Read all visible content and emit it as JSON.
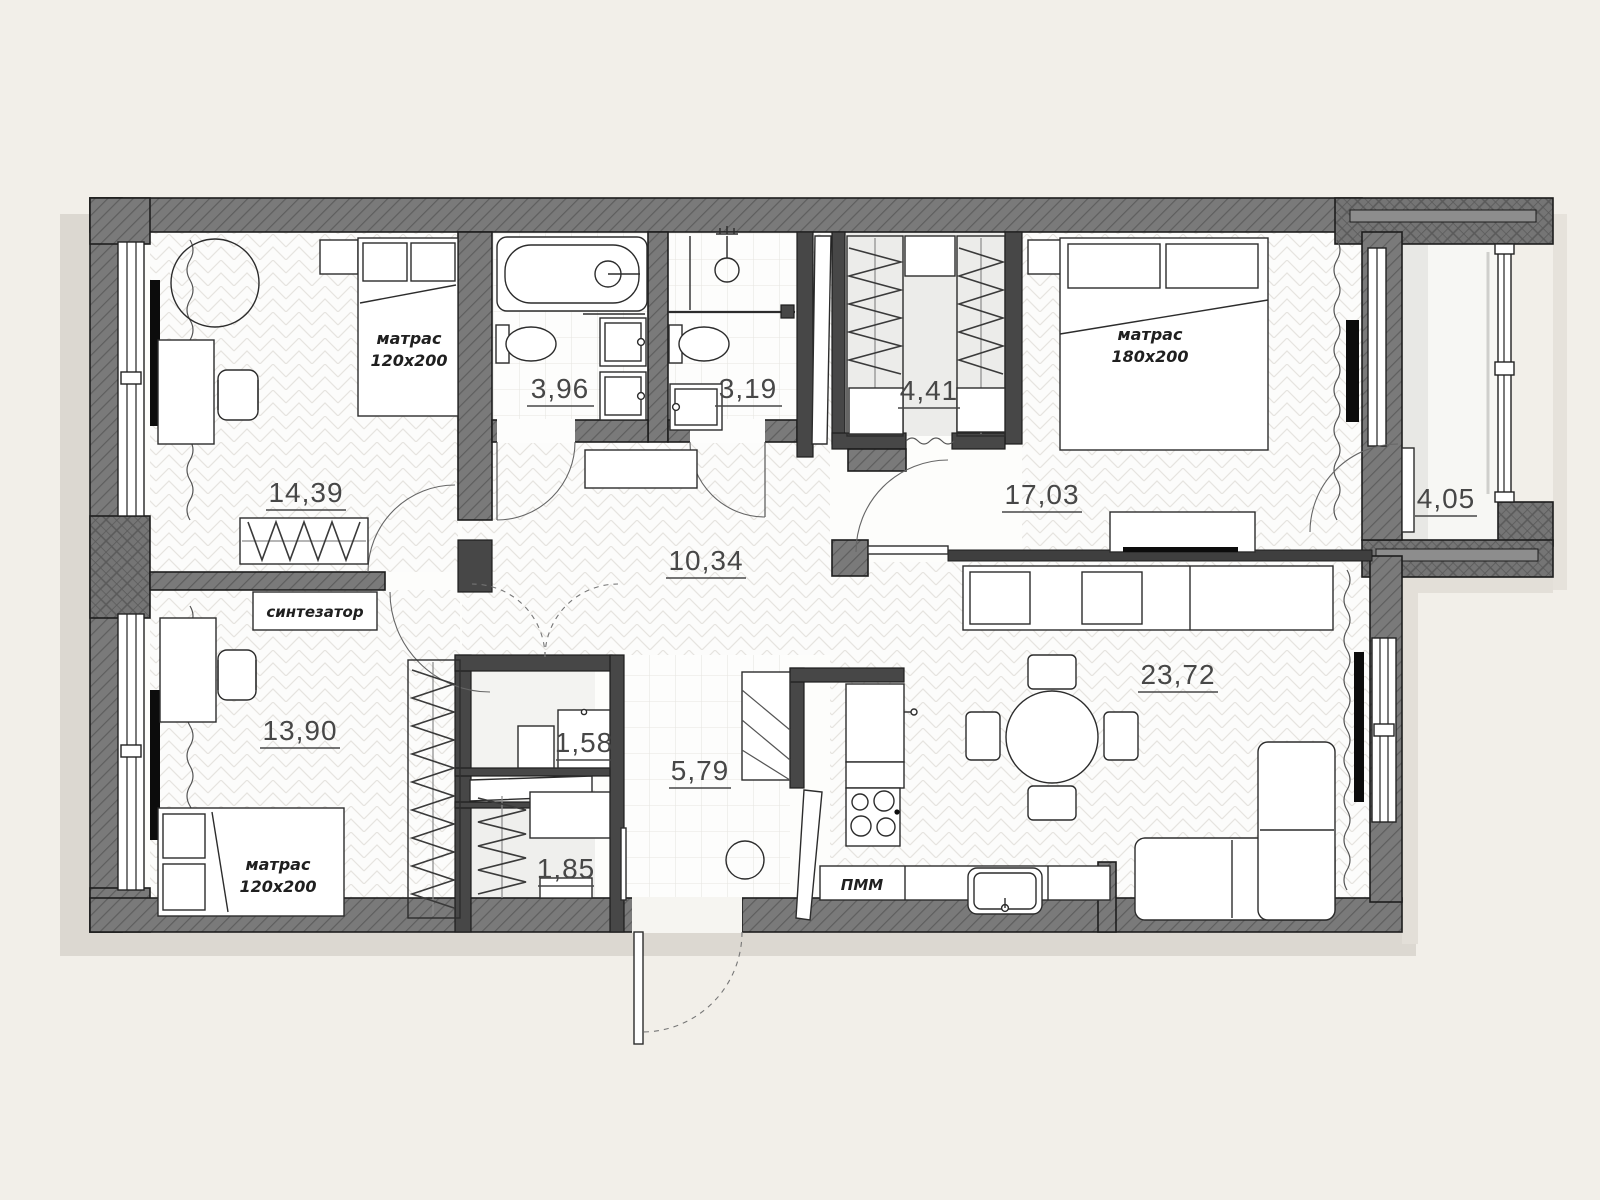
{
  "plan": {
    "background_color": "#f2efe9",
    "wall_color": "#767676",
    "partition_color": "#474747",
    "line_color": "#2c2c2c",
    "label_color": "#474747",
    "rooms": [
      {
        "id": "bedroom-top-left",
        "area": "14,39"
      },
      {
        "id": "bathroom",
        "area": "3,96"
      },
      {
        "id": "shower-room",
        "area": "3,19"
      },
      {
        "id": "wardrobe",
        "area": "4,41"
      },
      {
        "id": "master-bedroom",
        "area": "17,03"
      },
      {
        "id": "balcony",
        "area": "4,05"
      },
      {
        "id": "hallway",
        "area": "10,34"
      },
      {
        "id": "bedroom-bottom-left",
        "area": "13,90"
      },
      {
        "id": "storage-small",
        "area": "1,58"
      },
      {
        "id": "entry-hall",
        "area": "5,79"
      },
      {
        "id": "storage-lower",
        "area": "1,85"
      },
      {
        "id": "living-kitchen",
        "area": "23,72"
      }
    ],
    "labels": {
      "mattress": "матрас",
      "mattress_size_120": "120x200",
      "mattress_size_180": "180x200",
      "synthesizer": "синтезатор",
      "dishwasher": "ПММ"
    }
  }
}
